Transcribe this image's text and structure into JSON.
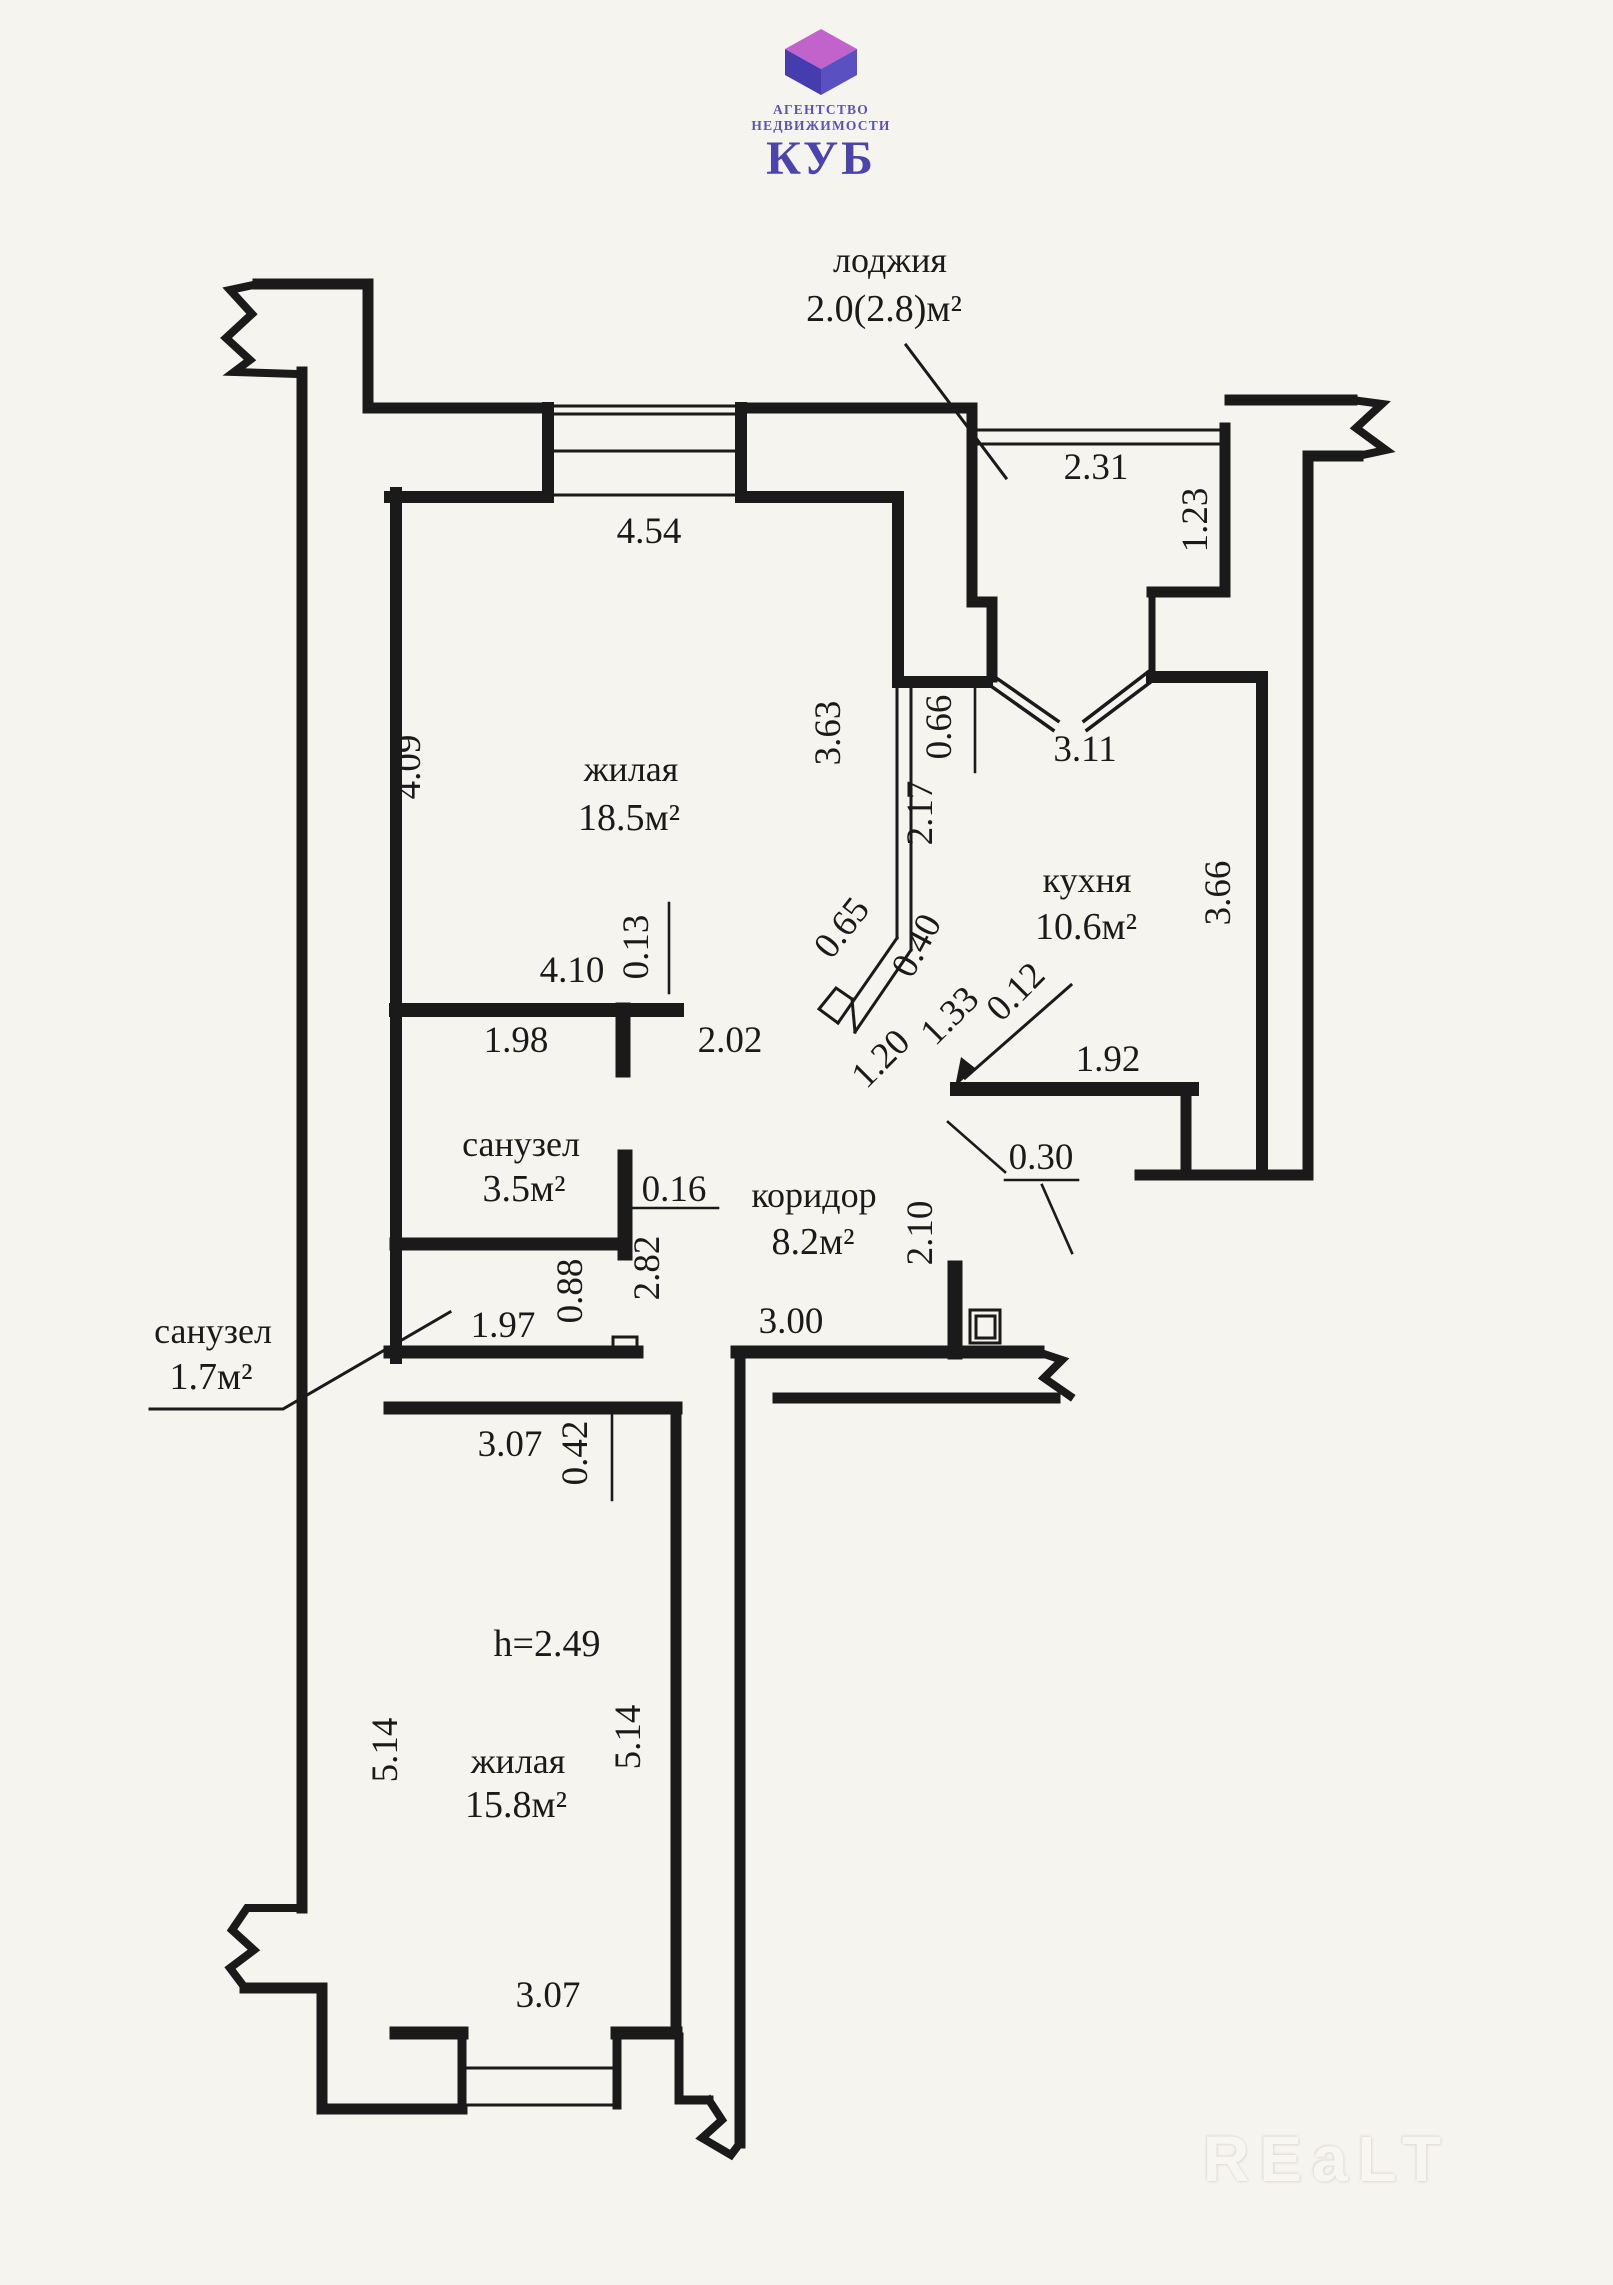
{
  "logo": {
    "line1": "АГЕНТСТВО",
    "line2": "НЕДВИЖИМОСТИ",
    "name": "КУБ",
    "colors": {
      "top": "#c263cb",
      "left": "#453cae",
      "right": "#5a50c2"
    }
  },
  "watermark": {
    "text": "REaLT"
  },
  "plan": {
    "rooms": [
      {
        "t": "лоджия",
        "x": 890,
        "y": 272,
        "s": 36
      },
      {
        "t": "2.0(2.8)м²",
        "x": 884,
        "y": 321,
        "s": 38
      },
      {
        "t": "жилая",
        "x": 631,
        "y": 781,
        "s": 36
      },
      {
        "t": "18.5м²",
        "x": 629,
        "y": 830,
        "s": 38
      },
      {
        "t": "кухня",
        "x": 1087,
        "y": 892,
        "s": 36
      },
      {
        "t": "10.6м²",
        "x": 1086,
        "y": 939,
        "s": 38
      },
      {
        "t": "санузел",
        "x": 521,
        "y": 1156,
        "s": 36
      },
      {
        "t": "3.5м²",
        "x": 524,
        "y": 1201,
        "s": 38
      },
      {
        "t": "коридор",
        "x": 814,
        "y": 1207,
        "s": 36
      },
      {
        "t": "8.2м²",
        "x": 813,
        "y": 1254,
        "s": 38
      },
      {
        "t": "санузел",
        "x": 213,
        "y": 1343,
        "s": 36
      },
      {
        "t": "1.7м²",
        "x": 211,
        "y": 1389,
        "s": 38
      },
      {
        "t": "h=2.49",
        "x": 547,
        "y": 1656,
        "s": 38
      },
      {
        "t": "жилая",
        "x": 518,
        "y": 1773,
        "s": 36
      },
      {
        "t": "15.8м²",
        "x": 516,
        "y": 1817,
        "s": 38
      }
    ],
    "dims": [
      {
        "t": "2.31",
        "x": 1096,
        "y": 479
      },
      {
        "t": "1.23",
        "x": 1207,
        "y": 520,
        "r": -90
      },
      {
        "t": "4.54",
        "x": 649,
        "y": 543
      },
      {
        "t": "4.09",
        "x": 420,
        "y": 767,
        "r": -90
      },
      {
        "t": "3.63",
        "x": 840,
        "y": 733,
        "r": -90
      },
      {
        "t": "0.66",
        "x": 951,
        "y": 727,
        "r": -90
      },
      {
        "t": "2.17",
        "x": 932,
        "y": 813,
        "r": -90
      },
      {
        "t": "3.11",
        "x": 1085,
        "y": 761
      },
      {
        "t": "3.66",
        "x": 1230,
        "y": 893,
        "r": -90
      },
      {
        "t": "4.10",
        "x": 572,
        "y": 982
      },
      {
        "t": "0.13",
        "x": 648,
        "y": 947,
        "r": -90
      },
      {
        "t": "1.98",
        "x": 516,
        "y": 1052
      },
      {
        "t": "2.02",
        "x": 730,
        "y": 1052
      },
      {
        "t": "0.65",
        "x": 851,
        "y": 935,
        "r": -52
      },
      {
        "t": "0.40",
        "x": 927,
        "y": 951,
        "r": -62
      },
      {
        "t": "1.33",
        "x": 958,
        "y": 1024,
        "r": -45
      },
      {
        "t": "0.12",
        "x": 1024,
        "y": 1000,
        "r": -45
      },
      {
        "t": "1.20",
        "x": 889,
        "y": 1067,
        "r": -45
      },
      {
        "t": "1.92",
        "x": 1108,
        "y": 1071
      },
      {
        "t": "0.30",
        "x": 1041,
        "y": 1169
      },
      {
        "t": "0.16",
        "x": 674,
        "y": 1201
      },
      {
        "t": "2.82",
        "x": 659,
        "y": 1268,
        "r": -90
      },
      {
        "t": "0.88",
        "x": 582,
        "y": 1291,
        "r": -90
      },
      {
        "t": "2.10",
        "x": 932,
        "y": 1233,
        "r": -90
      },
      {
        "t": "3.00",
        "x": 791,
        "y": 1333
      },
      {
        "t": "1.97",
        "x": 503,
        "y": 1337
      },
      {
        "t": "0.42",
        "x": 587,
        "y": 1453,
        "r": -90
      },
      {
        "t": "3.07",
        "x": 510,
        "y": 1456
      },
      {
        "t": "5.14",
        "x": 397,
        "y": 1750,
        "r": -90
      },
      {
        "t": "5.14",
        "x": 640,
        "y": 1737,
        "r": -90
      },
      {
        "t": "3.07",
        "x": 548,
        "y": 2007
      }
    ]
  }
}
